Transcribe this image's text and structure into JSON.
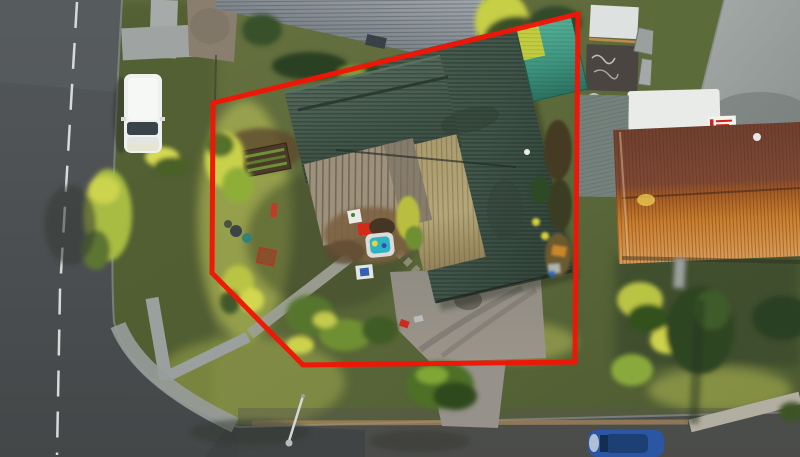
{
  "meta": {
    "type": "aerial-drone-photograph",
    "subject": "Residential corner property at sunset with red surveyed boundary overlay",
    "width_px": 800,
    "height_px": 457
  },
  "boundary": {
    "label": "property-boundary-overlay",
    "color": "#f21506",
    "stroke_width": 5,
    "points": "213,103 578,14 575,362 303,365 212,273"
  },
  "colors": {
    "boundary_red": "#f21506",
    "main_roof_green": "#44584a",
    "khaki_roof_sunlit": "#b2a478",
    "pergola_tan": "#a1947f",
    "neighbour_roof_grey": "#99a0a6",
    "terracotta_shaded": "#7e4a36",
    "terracotta_sunlit": "#c97f2e",
    "shed_teal": "#4fab92",
    "shed_lime": "#c8cf3e",
    "van_white": "#eff1ee",
    "caravan_white": "#e9ebe8",
    "car_blue": "#2a56a4",
    "asphalt": "#4b4f51",
    "concrete": "#9da2a1",
    "lawn_olive": "#57643a",
    "sunlit_grass": "#bcc257",
    "pool_teal": "#2fb3c4",
    "toy_red": "#d5291a"
  },
  "objects": {
    "property_boundary": "red boundary line drawn around corner lot",
    "main_house": "L-shaped house with dark green corrugated roof",
    "khaki_roof_plane": "sunlit khaki roof plane",
    "pergola": "translucent corrugated pergola over patio",
    "garden_shed": "teal and lime garden shed in rear corner",
    "paddling_pool": "kids paddling pool with teal water",
    "sandpit": "small brown sandpit",
    "toys": "scattered garden toys and bins",
    "driveway": "concrete driveway to south street",
    "front_path": "concrete walkway from street corner to patio",
    "white_van": "white van parked on west verge",
    "blue_car": "blue car parked on south street",
    "caravan": "white caravan with red-lettered sign",
    "neighbour_roof_north": "grey corrugated neighbour roof",
    "neighbour_roof_east": "terracotta tiled neighbour roof",
    "graffiti_shed": "dark shed with white graffiti",
    "concrete_pad": "large concrete pad, north-east",
    "street_west": "asphalt road with dashed centre line",
    "street_south": "asphalt road along bottom edge",
    "streetlight": "street lamp arm over south road",
    "trees": "sunlit trees, hedges and shrubs",
    "lawn": "olive green lawns and verges"
  }
}
